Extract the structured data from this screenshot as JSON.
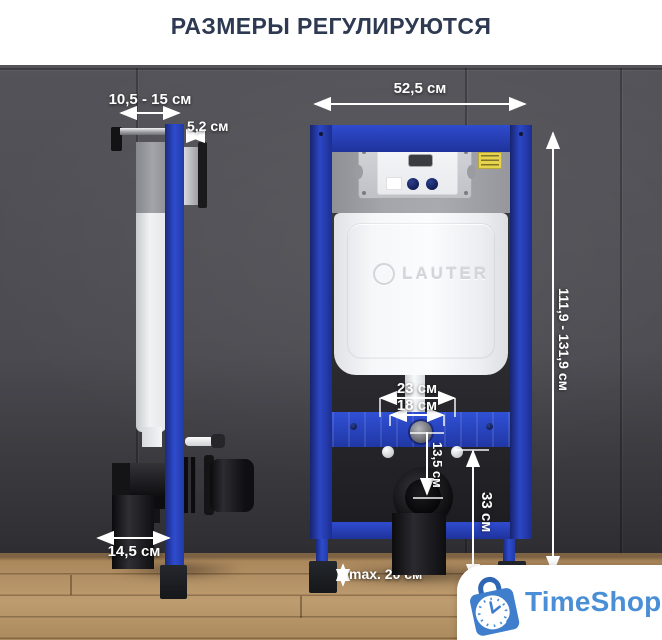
{
  "title": "РАЗМЕРЫ РЕГУЛИРУЮТСЯ",
  "dims": {
    "offset_wall": "10,5 - 15 см",
    "profile_depth": "5,2 см",
    "frame_width": "52,5 см",
    "frame_height": "111,9 - 131,9 см",
    "anchor_outer": "23 см",
    "anchor_inner": "18 см",
    "outlet_drop": "13,5 см",
    "outlet_axis_height": "33 см",
    "leg_adjust": "max. 20 см",
    "drain_offset": "14,5 см"
  },
  "brand": {
    "embossed": "LAUTER"
  },
  "watermark": {
    "name": "TimeShop"
  },
  "icons": {
    "logo": "shopping-bag-clock-icon"
  },
  "colors": {
    "frame_blue": "#2c47c6",
    "title_navy": "#2e3a52",
    "logo_blue": "#4a8fd6",
    "wall_gray": "#4b4b51",
    "floor_wood": "#b08a5e"
  }
}
